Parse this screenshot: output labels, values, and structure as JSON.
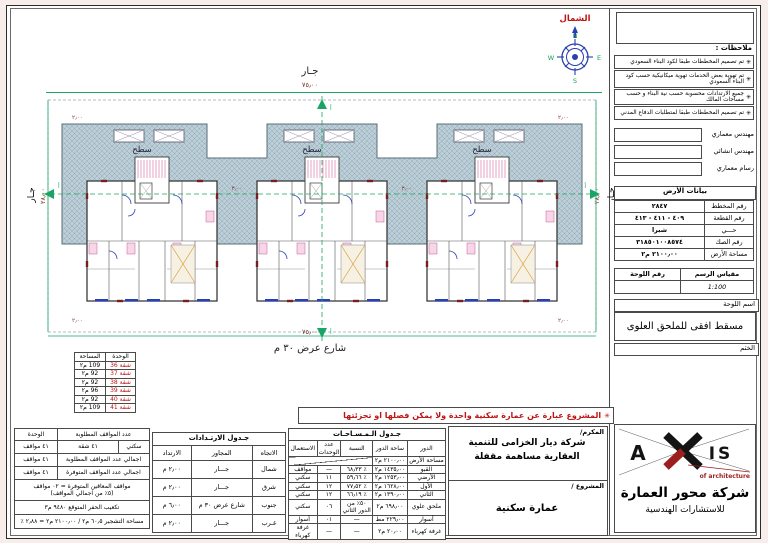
{
  "colors": {
    "accent_green": "#19a564",
    "north_red": "#c01414",
    "hatch_fill": "#bccfd8",
    "logo_red": "#9c1f1f",
    "door_blue": "#2a3fb0",
    "stair_pink": "#d46a9f"
  },
  "compass": {
    "north_label": "الشمال",
    "n": "N",
    "e": "E",
    "s": "S",
    "w": "W"
  },
  "plan": {
    "roof_label": "سطح",
    "neighbor_top": "جـار",
    "neighbor_left": "جـار",
    "neighbor_right": "جـار",
    "dim_top": "٧٥٫٠٠",
    "dim_bottom": "٧٥٫٠٠",
    "dim_left": "٢٨٫٠٠",
    "dim_right": "٢٨٫٠٠",
    "street_label": "شارع عرض ٣٠ م",
    "section_marker": "أ",
    "small_dims": {
      "tl": "٢٫٠٠",
      "tr": "٢٫٠٠",
      "bl": "٢٫٠٠",
      "br": "٢٫٠٠",
      "gap1": "٣٫٠٠",
      "gap2": "٣٫٠٠"
    }
  },
  "apartment_legend": {
    "header_unit": "الوحدة",
    "header_area": "المساحة",
    "rows": [
      {
        "unit": "شقة 36",
        "area": "109 م٢"
      },
      {
        "unit": "شقة 37",
        "area": "92 م٢"
      },
      {
        "unit": "شقة 38",
        "area": "92 م٢"
      },
      {
        "unit": "شقة 39",
        "area": "96 م٢"
      },
      {
        "unit": "شقة 40",
        "area": "92 م٢"
      },
      {
        "unit": "شقة 41",
        "area": "109 م٢"
      }
    ]
  },
  "red_note": {
    "asterisk": "✳",
    "text": "المشروع عبارة عن عمارة سكنية واحدة ولا يمكن فصلها او تجزئتها"
  },
  "owner": {
    "label": "المكرم/",
    "name": "شركة ديار الخزامى للتنمية العقارية مساهمة مقفلة",
    "project_label": "المشروع /",
    "project": "عمارة سكنية"
  },
  "areas_table": {
    "title": "جـدول الـمـسـاحـات",
    "headers": {
      "floor": "الدور",
      "area": "ساحة الدور",
      "ratio": "النسبة",
      "units": "عدد الوحدات",
      "use": "الاستعمال"
    },
    "land_row": {
      "label": "مساحة الأرض",
      "value": "٢١٠٠٫٠٠ م٢"
    },
    "rows": [
      {
        "floor": "القبو",
        "area": "١٤٣٥٫٠٠ م٢",
        "ratio": "٪ ٦٨٫٣٣",
        "units": "—",
        "use": "مواقف"
      },
      {
        "floor": "الأرضي",
        "area": "١٢٥٣٫٠٠ م٢",
        "ratio": "٪ ٥٩٫٦٦",
        "units": "١١",
        "use": "سكني"
      },
      {
        "floor": "الأول",
        "area": "١٦٢٨٫٠٠ م٢",
        "ratio": "٪ ٧٧٫٥٢",
        "units": "١٢",
        "use": "سكني"
      },
      {
        "floor": "الثاني",
        "area": "١٣٩٠٫٠٠ م٢",
        "ratio": "٪ ٦٦٫١٩",
        "units": "١٢",
        "use": "سكني"
      },
      {
        "floor": "ملحق علوي",
        "area": "٦٩٨٫٠٠ م٢",
        "ratio": "٥٠٪ من الدور الثاني",
        "units": "٠٦",
        "use": "سكني"
      },
      {
        "floor": "أسوار",
        "area": "٢٢٩٫٠٠ مط",
        "ratio": "—",
        "units": "٠١",
        "use": "أسوار"
      },
      {
        "floor": "غرفة كهرباء",
        "area": "٢٠٫٠٠ م٢",
        "ratio": "—",
        "units": "—",
        "use": "غرفة كهرباء"
      }
    ]
  },
  "setbacks_table": {
    "title": "جـدول الارتـدادات",
    "headers": {
      "dir": "الاتجاه",
      "adj": "المجاور",
      "val": "الارتداد"
    },
    "rows": [
      {
        "dir": "شمال",
        "adj": "جـــار",
        "val": "٢٫٠٠ م"
      },
      {
        "dir": "شرق",
        "adj": "جـــار",
        "val": "٢٫٠٠ م"
      },
      {
        "dir": "جنوب",
        "adj": "شارع عرض ٣٠ م",
        "val": "٦٫٠٠ م"
      },
      {
        "dir": "غـرب",
        "adj": "جـــار",
        "val": "٢٫٠٠ م"
      }
    ]
  },
  "parking_table": {
    "header_required": "عدد المواقف المطلوبة",
    "header_unit": "الوحدة",
    "row_residential": {
      "use": "سكني",
      "count": "٤١ شقة",
      "result": "٤١ مواقف"
    },
    "required_total_label": "اجمالي عدد المواقف المطلوبة",
    "required_total": "٤١ مواقف",
    "available_total_label": "اجمالي عدد المواقف المتوفرة",
    "available_total": "٤١ مواقف",
    "disabled_line1": "مواقف المعاقين المتوفرة = ٠٢ مواقف",
    "disabled_line2": "(٥٪ من اجمالي المواقف)",
    "excavation": "تكعيب الحفر المتوقع  ٩٤٨٠ م٣",
    "landscape": "مساحة التشجير  ٦٠٫٥ م٢ / ٢١٠٠٫٠٠ م٢ = ٢٫٨٨ ٪"
  },
  "titleblock": {
    "notes_title": "ملاحظات :",
    "notes": [
      {
        "mark": "✳",
        "text": "تم تصميم المخططات طبقا لكود البناء السعودي"
      },
      {
        "mark": "✳",
        "text": "تم تهوية بعض الخدمات تهوية ميكانيكية حسب كود البناء السعودي"
      },
      {
        "mark": "✳",
        "text": "جميع الارتدادات محسوبة حسب نية البناء و حسب مساحات المالك"
      },
      {
        "mark": "✳",
        "text": "تم تصميم المخططات طبقا لمتطلبات الدفاع المدني"
      }
    ],
    "staff": [
      {
        "label": "مهندس معماري"
      },
      {
        "label": "مهندس انشائي"
      },
      {
        "label": "رسام معماري"
      }
    ],
    "land_data": {
      "title": "بيانات الأرض",
      "rows": [
        {
          "label": "رقم المخطط",
          "value": "٢٨٤٧"
        },
        {
          "label": "رقم القطعة",
          "value": "٤٠٩ - ٤١١ - ٤١٣"
        },
        {
          "label": "حـــي",
          "value": "شبرا"
        },
        {
          "label": "رقم الصك",
          "value": "٣١٨٥٠١٠٠٨٥٧٤"
        },
        {
          "label": "مساحة الأرض",
          "value": "٢١٠٠٫٠٠ م٢"
        }
      ]
    },
    "scale_label": "مقياس الرسم",
    "scale_value": "1:100",
    "sheet_no_label": "رقم اللوحة",
    "sheet_no_value": "",
    "sheet_name_label": "اسم اللوحة",
    "sheet_name": "مسقط افقى للملحق العلوى",
    "stamp_label": "الختم",
    "company": {
      "logo_a": "A",
      "logo_is": "IS",
      "tagline": "of architecture",
      "name": "شركة محور العمارة",
      "sub": "للاستشارات الهندسية"
    }
  }
}
